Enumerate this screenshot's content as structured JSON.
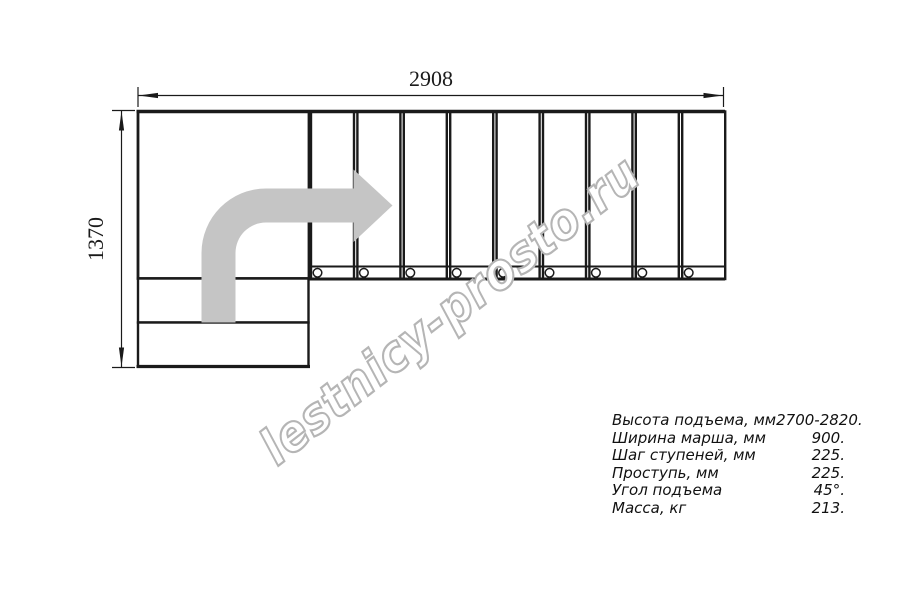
{
  "drawing": {
    "title": "L-shaped staircase plan",
    "width_dimension_label": "2908",
    "height_dimension_label": "1370",
    "steps_count": 9,
    "lower_steps_count": 2,
    "line_color": "#1a1a1a",
    "arrow_color": "#c5c5c5",
    "watermark_text": "lestnicy-prosto.ru",
    "watermark_color": "#b5b5b5"
  },
  "specs": {
    "rows": [
      {
        "label": "Высота подъема, мм",
        "value": "2700-2820."
      },
      {
        "label": "Ширина марша, мм",
        "value": "900."
      },
      {
        "label": "Шаг ступеней, мм",
        "value": "225."
      },
      {
        "label": "Проступь, мм",
        "value": "225."
      },
      {
        "label": "Угол подъема",
        "value": "45°."
      },
      {
        "label": "Масса, кг",
        "value": "213."
      }
    ]
  }
}
